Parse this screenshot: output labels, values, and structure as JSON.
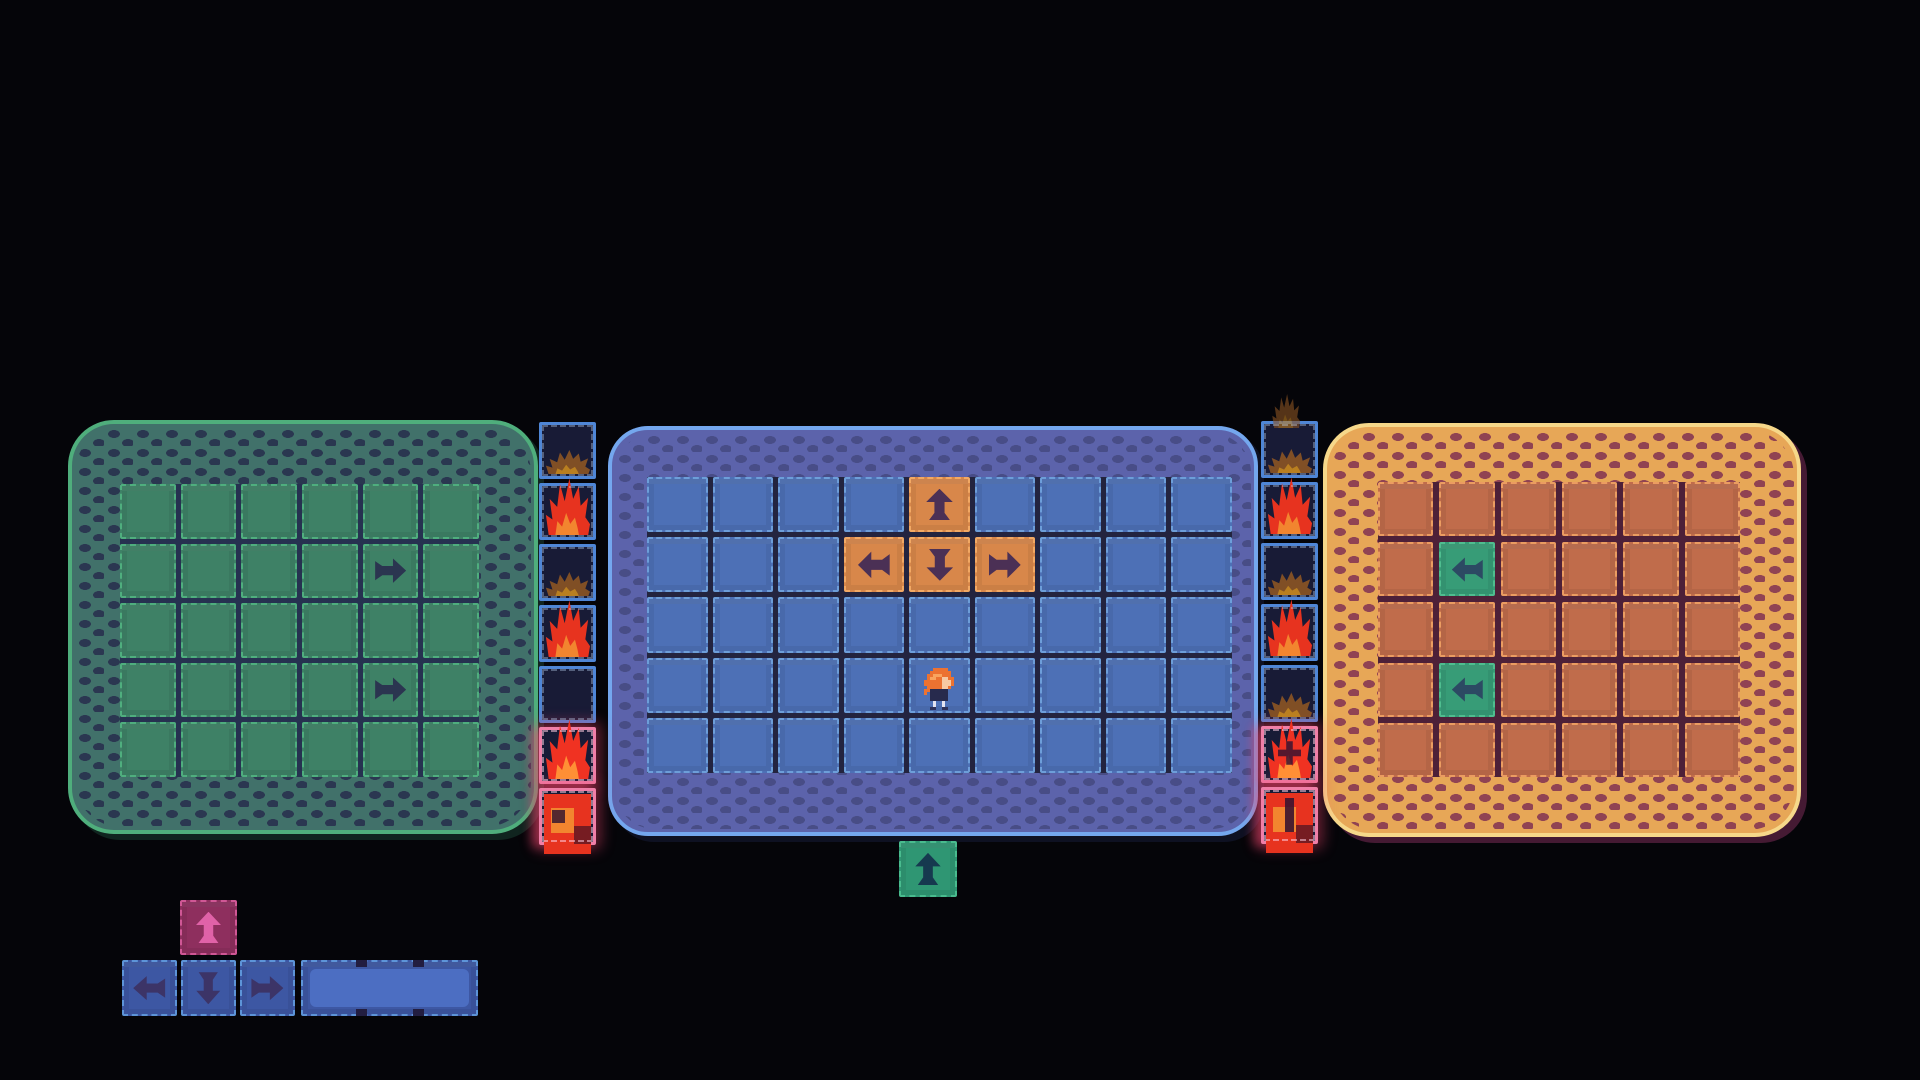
{
  "background": "#050509",
  "rooms": [
    {
      "id": "green",
      "x": 68,
      "y": 420,
      "w": 470,
      "h": 414,
      "radius": 46,
      "pad": {
        "t": 60,
        "l": 48,
        "r": 55,
        "b": 53
      },
      "grid": {
        "cols": 6,
        "rows": 5,
        "gap": 5
      },
      "colors": {
        "outline": "#4fae7c",
        "border_fill": "#41716a",
        "speckle": "#2a3450",
        "floor": "#263150",
        "tile_fill": "#3e8166",
        "tile_border": "#4fae7e",
        "arrow": "#2b3550",
        "shadow": "#10241f"
      },
      "special_tiles": [
        {
          "row": 1,
          "col": 4,
          "icon": "arrow-right",
          "colorway": null
        },
        {
          "row": 3,
          "col": 4,
          "icon": "arrow-right",
          "colorway": null
        }
      ]
    },
    {
      "id": "blue",
      "x": 608,
      "y": 426,
      "w": 650,
      "h": 410,
      "radius": 40,
      "pad": {
        "t": 47,
        "l": 35,
        "r": 22,
        "b": 59
      },
      "grid": {
        "cols": 9,
        "rows": 5,
        "gap": 5
      },
      "colors": {
        "outline": "#74a7ee",
        "border_fill": "#5c63ab",
        "speckle": "#474c85",
        "floor": "#23243f",
        "tile_fill": "#4d70b6",
        "tile_border": "#6d9ed9",
        "arrow": "#3c3467",
        "shadow": "#0e1122"
      },
      "special_tiles": [
        {
          "row": 0,
          "col": 4,
          "icon": "arrow-up",
          "colorway": "orange_pad"
        },
        {
          "row": 1,
          "col": 3,
          "icon": "arrow-left",
          "colorway": "orange_pad"
        },
        {
          "row": 1,
          "col": 4,
          "icon": "arrow-down",
          "colorway": "orange_pad"
        },
        {
          "row": 1,
          "col": 5,
          "icon": "arrow-right",
          "colorway": "orange_pad"
        }
      ]
    },
    {
      "id": "orange",
      "x": 1323,
      "y": 423,
      "w": 478,
      "h": 414,
      "radius": 46,
      "pad": {
        "t": 55,
        "l": 51,
        "r": 57,
        "b": 56
      },
      "grid": {
        "cols": 6,
        "rows": 5,
        "gap": 6
      },
      "colors": {
        "outline": "#f6d88a",
        "border_fill": "#e7a757",
        "speckle": "#8c3e53",
        "floor": "#4d2038",
        "tile_fill": "#c06c4b",
        "tile_border": "#eb9c61",
        "arrow": "#2c4a63",
        "shadow": "#451a33"
      },
      "special_tiles": [
        {
          "row": 1,
          "col": 1,
          "icon": "arrow-left",
          "colorway": "green_pad"
        },
        {
          "row": 3,
          "col": 1,
          "icon": "arrow-left",
          "colorway": "green_pad"
        }
      ]
    }
  ],
  "tile_colorways": {
    "orange_pad": {
      "fill": "#d8874a",
      "border": "#f2a964",
      "arrow": "#4b3055"
    },
    "green_pad": {
      "fill": "#379c77",
      "border": "#4fbd8f",
      "arrow": "#2c4a63"
    },
    "green_exit": {
      "fill": "#2f9673",
      "border": "#49bb8e",
      "arrow": "#16394f"
    },
    "pink_ctl": {
      "fill": "#8e2f5e",
      "border": "#cf5795",
      "arrow": "#e062a8"
    },
    "blue_ctl": {
      "fill": "#3d57a3",
      "border": "#5d94d8",
      "arrow": "#3c3467"
    },
    "blue_slot": {
      "fill": "#3d57a3",
      "border": "#5d94d8",
      "inner": "#4c6ec2",
      "notch": "#221d40"
    }
  },
  "fire_palette": {
    "tile_bg": "#181b36",
    "tile_border": "#4f86d6",
    "glow_border": "#f07fa8",
    "glow": "rgba(240,70,110,0.42)",
    "red": "#e7331f",
    "red_bright": "#f03222",
    "orange": "#f2852f",
    "orange_bright": "#ff8f35",
    "ember": "#8a5424",
    "ember_core": "#c8881f"
  },
  "fire_strips": [
    {
      "id": "left",
      "x": 539,
      "y": 422,
      "tile_w": 57,
      "tile_h": 57,
      "pitch": 61,
      "flames_above": false,
      "tiles": [
        {
          "fire": "ember"
        },
        {
          "fire": "fire"
        },
        {
          "fire": "ember"
        },
        {
          "fire": "fire"
        },
        {
          "fire": "dark"
        },
        {
          "fire": "blaze",
          "glow": true
        },
        {
          "fire": "blaze-solid",
          "glow": true,
          "mark": "dot"
        }
      ]
    },
    {
      "id": "right",
      "x": 1261,
      "y": 421,
      "tile_w": 57,
      "tile_h": 57,
      "pitch": 61,
      "flames_above": true,
      "tiles": [
        {
          "fire": "ember"
        },
        {
          "fire": "fire"
        },
        {
          "fire": "ember"
        },
        {
          "fire": "fire"
        },
        {
          "fire": "ember"
        },
        {
          "fire": "blaze",
          "glow": true,
          "mark": "cross"
        },
        {
          "fire": "blaze-solid",
          "glow": true,
          "mark": "bar"
        }
      ]
    }
  ],
  "loose_tiles": [
    {
      "name": "exit-arrow-tile",
      "x": 899,
      "y": 841,
      "w": 58,
      "h": 56,
      "colorway": "green_exit",
      "icon": "arrow-up",
      "interactable": true
    },
    {
      "name": "control-arrow-up",
      "x": 180,
      "y": 900,
      "w": 57,
      "h": 55,
      "colorway": "pink_ctl",
      "icon": "arrow-up",
      "interactable": true
    },
    {
      "name": "control-arrow-left",
      "x": 122,
      "y": 960,
      "w": 55,
      "h": 56,
      "colorway": "blue_ctl",
      "icon": "arrow-left",
      "interactable": true
    },
    {
      "name": "control-arrow-down",
      "x": 181,
      "y": 960,
      "w": 55,
      "h": 56,
      "colorway": "blue_ctl",
      "icon": "arrow-down",
      "interactable": true
    },
    {
      "name": "control-arrow-right",
      "x": 240,
      "y": 960,
      "w": 55,
      "h": 56,
      "colorway": "blue_ctl",
      "icon": "arrow-right",
      "interactable": true
    },
    {
      "name": "control-slot",
      "x": 301,
      "y": 960,
      "w": 177,
      "h": 56,
      "colorway": "blue_slot",
      "icon": null,
      "interactable": true
    }
  ],
  "player": {
    "room": "blue",
    "row": 3,
    "col": 4,
    "colors": {
      "hair": "#ec7231",
      "hair_highlight": "#f9a45e",
      "face": "#f6c9a2",
      "body": "#272a4d",
      "legs": "#e3e3f0",
      "shoes": "#2e3158"
    }
  }
}
